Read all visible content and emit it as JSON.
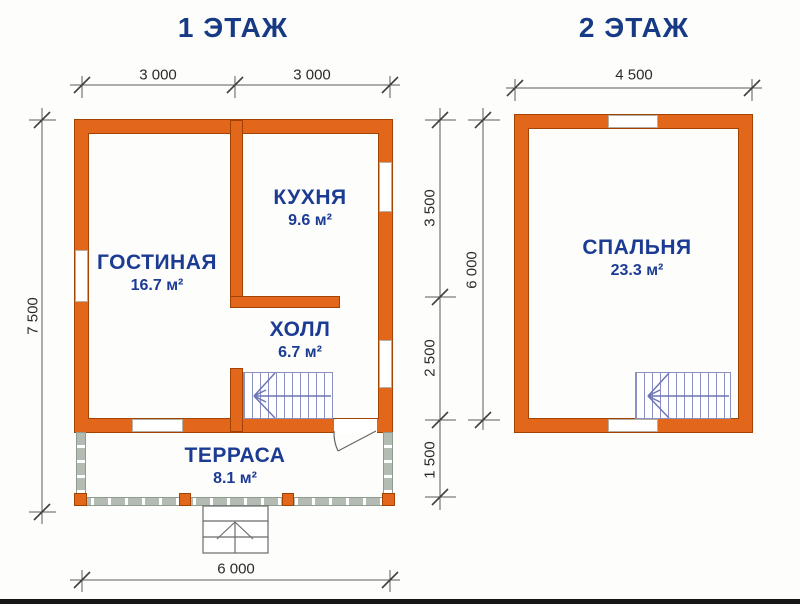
{
  "colors": {
    "wall_fill": "#e3671a",
    "wall_outline": "#a34302",
    "label_blue": "#1c3c94",
    "title_blue": "#173a85",
    "stair_line": "#8a91c2"
  },
  "floor1": {
    "title": "1 ЭТАЖ",
    "rooms": [
      {
        "name": "ГОСТИНАЯ",
        "area": "16.7 м²"
      },
      {
        "name": "КУХНЯ",
        "area": "9.6 м²"
      },
      {
        "name": "ХОЛЛ",
        "area": "6.7 м²"
      },
      {
        "name": "ТЕРРАСА",
        "area": "8.1 м²"
      }
    ],
    "dims": {
      "width_left": "3 000",
      "width_right": "3 000",
      "total_height": "7 500",
      "depth_kitchen": "3 500",
      "depth_hall": "2 500",
      "depth_terrace": "1 500",
      "total_width": "6 000"
    }
  },
  "floor2": {
    "title": "2 ЭТАЖ",
    "rooms": [
      {
        "name": "СПАЛЬНЯ",
        "area": "23.3 м²"
      }
    ],
    "dims": {
      "width": "4 500",
      "depth": "6 000"
    }
  }
}
